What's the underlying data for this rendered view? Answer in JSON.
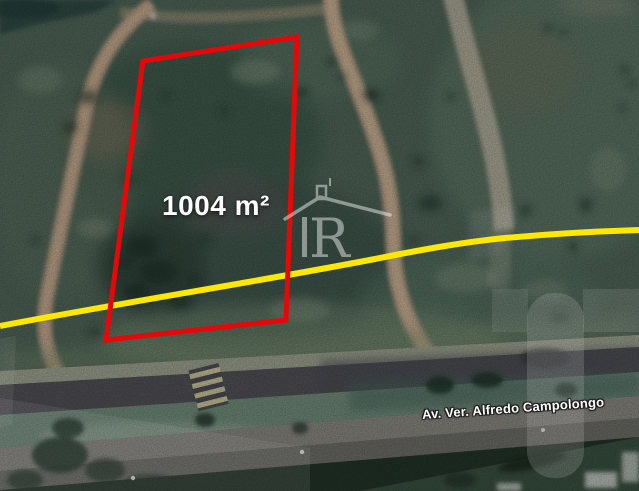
{
  "map": {
    "area_label": "1004 m²",
    "street_label": "Av. Ver. Alfredo Campolongo",
    "watermark_letter": "R",
    "colors": {
      "plot_outline": "#e60808",
      "boundary_line": "#ffe800"
    }
  }
}
